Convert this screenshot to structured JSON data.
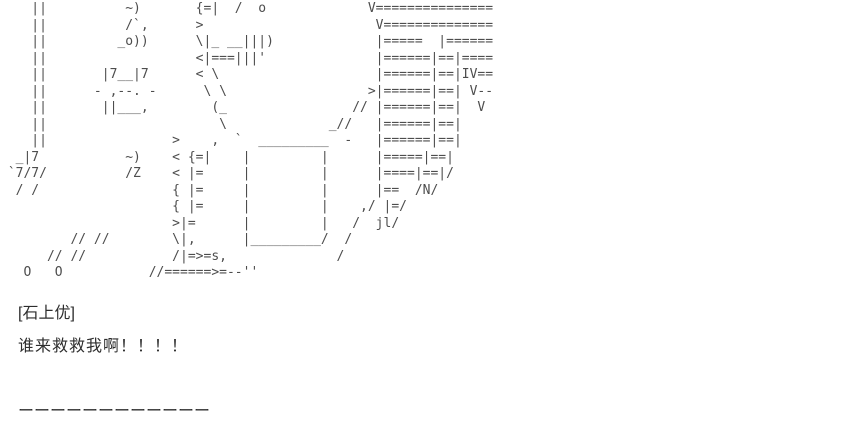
{
  "page": {
    "background": "#ffffff",
    "art_color": "#4d4d4d",
    "text_color": "#2d2d2d"
  },
  "ascii_art": {
    "lines": [
      "    ||          ~)       {=|  /  o             V===============",
      "    ||          /`,      >                      V==============",
      "    ||         _o))      \\|_ __|||)             |=====  |======",
      "    ||                   <|===|||'              |======|==|====",
      "    ||       |7__|7      < \\                    |======|==|IV==",
      "    ||      - ,--. -      \\ \\                  >|======|==| V--",
      "    ||       ||___,        (_                // |======|==|  V",
      "    ||                      \\             _//   |======|==|",
      "    ||                >    ,  `  _________  -   |======|==|",
      "  _|7           ~)    < {=|    |         |      |=====|==|",
      " `7/7/          /Z    < |=     |         |      |====|==|/",
      "  / /                 { |=     |         |      |==  /N/",
      "                      { |=     |         |    ,/ |=/",
      "                      >|=      |         |   /  jl/",
      "         // //        \\|,      |_________/  /",
      "      // //           /|=>=s,              /",
      "   O   O           //======>=--''"
    ]
  },
  "post": {
    "character_tag": "[石上优]",
    "dialogue": "谁来救救我啊！！！！",
    "divider": "ーーーーーーーーーーーー"
  }
}
